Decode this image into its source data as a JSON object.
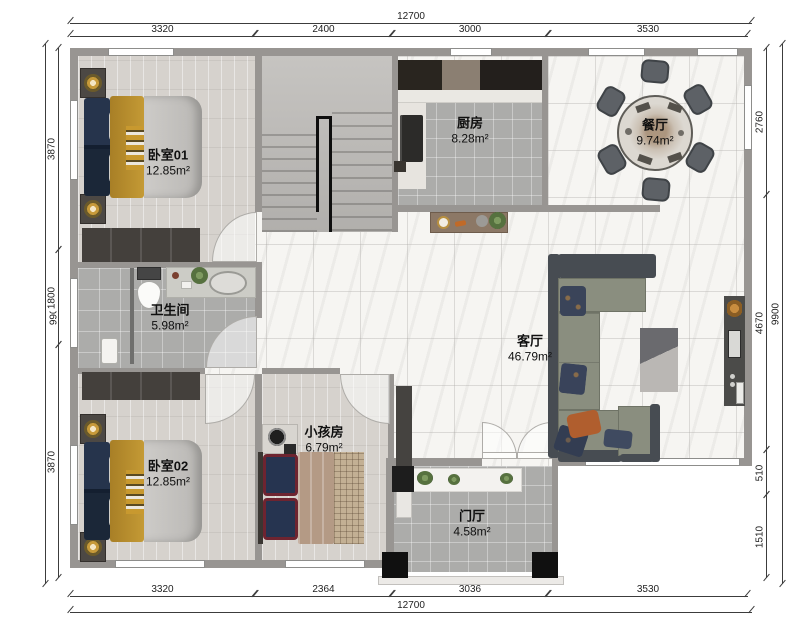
{
  "rooms": [
    {
      "id": "bedroom-01",
      "name": "卧室01",
      "area": "12.85m²"
    },
    {
      "id": "kitchen",
      "name": "厨房",
      "area": "8.28m²"
    },
    {
      "id": "dining-room",
      "name": "餐厅",
      "area": "9.74m²"
    },
    {
      "id": "bathroom",
      "name": "卫生间",
      "area": "5.98m²"
    },
    {
      "id": "living-room",
      "name": "客厅",
      "area": "46.79m²"
    },
    {
      "id": "kids-room",
      "name": "小孩房",
      "area": "6.79m²"
    },
    {
      "id": "bedroom-02",
      "name": "卧室02",
      "area": "12.85m²"
    },
    {
      "id": "entry-hall",
      "name": "门厅",
      "area": "4.58m²"
    }
  ],
  "dimensions": {
    "top": {
      "overall": "12700",
      "segments": [
        "3320",
        "2400",
        "3000",
        "3530"
      ]
    },
    "bottom": {
      "overall": "12700",
      "segments": [
        "3320",
        "2364",
        "3036",
        "3530"
      ]
    },
    "left": {
      "overall": "9900",
      "segments": [
        "3870",
        "1800",
        "3870"
      ]
    },
    "right": {
      "overall": "9900",
      "segments": [
        "2760",
        "4670",
        "510",
        "1510"
      ]
    }
  },
  "colors": {
    "wall": "#989592",
    "wood_floor": "#d6d2cd",
    "tile_floor": "#acacaa",
    "marble_floor": "#f6f5f2",
    "bed_accent_yellow": "#b8902e",
    "bed_accent_navy": "#24324a",
    "sofa_seat": "#8a8e7f",
    "sofa_frame": "#474c52"
  }
}
